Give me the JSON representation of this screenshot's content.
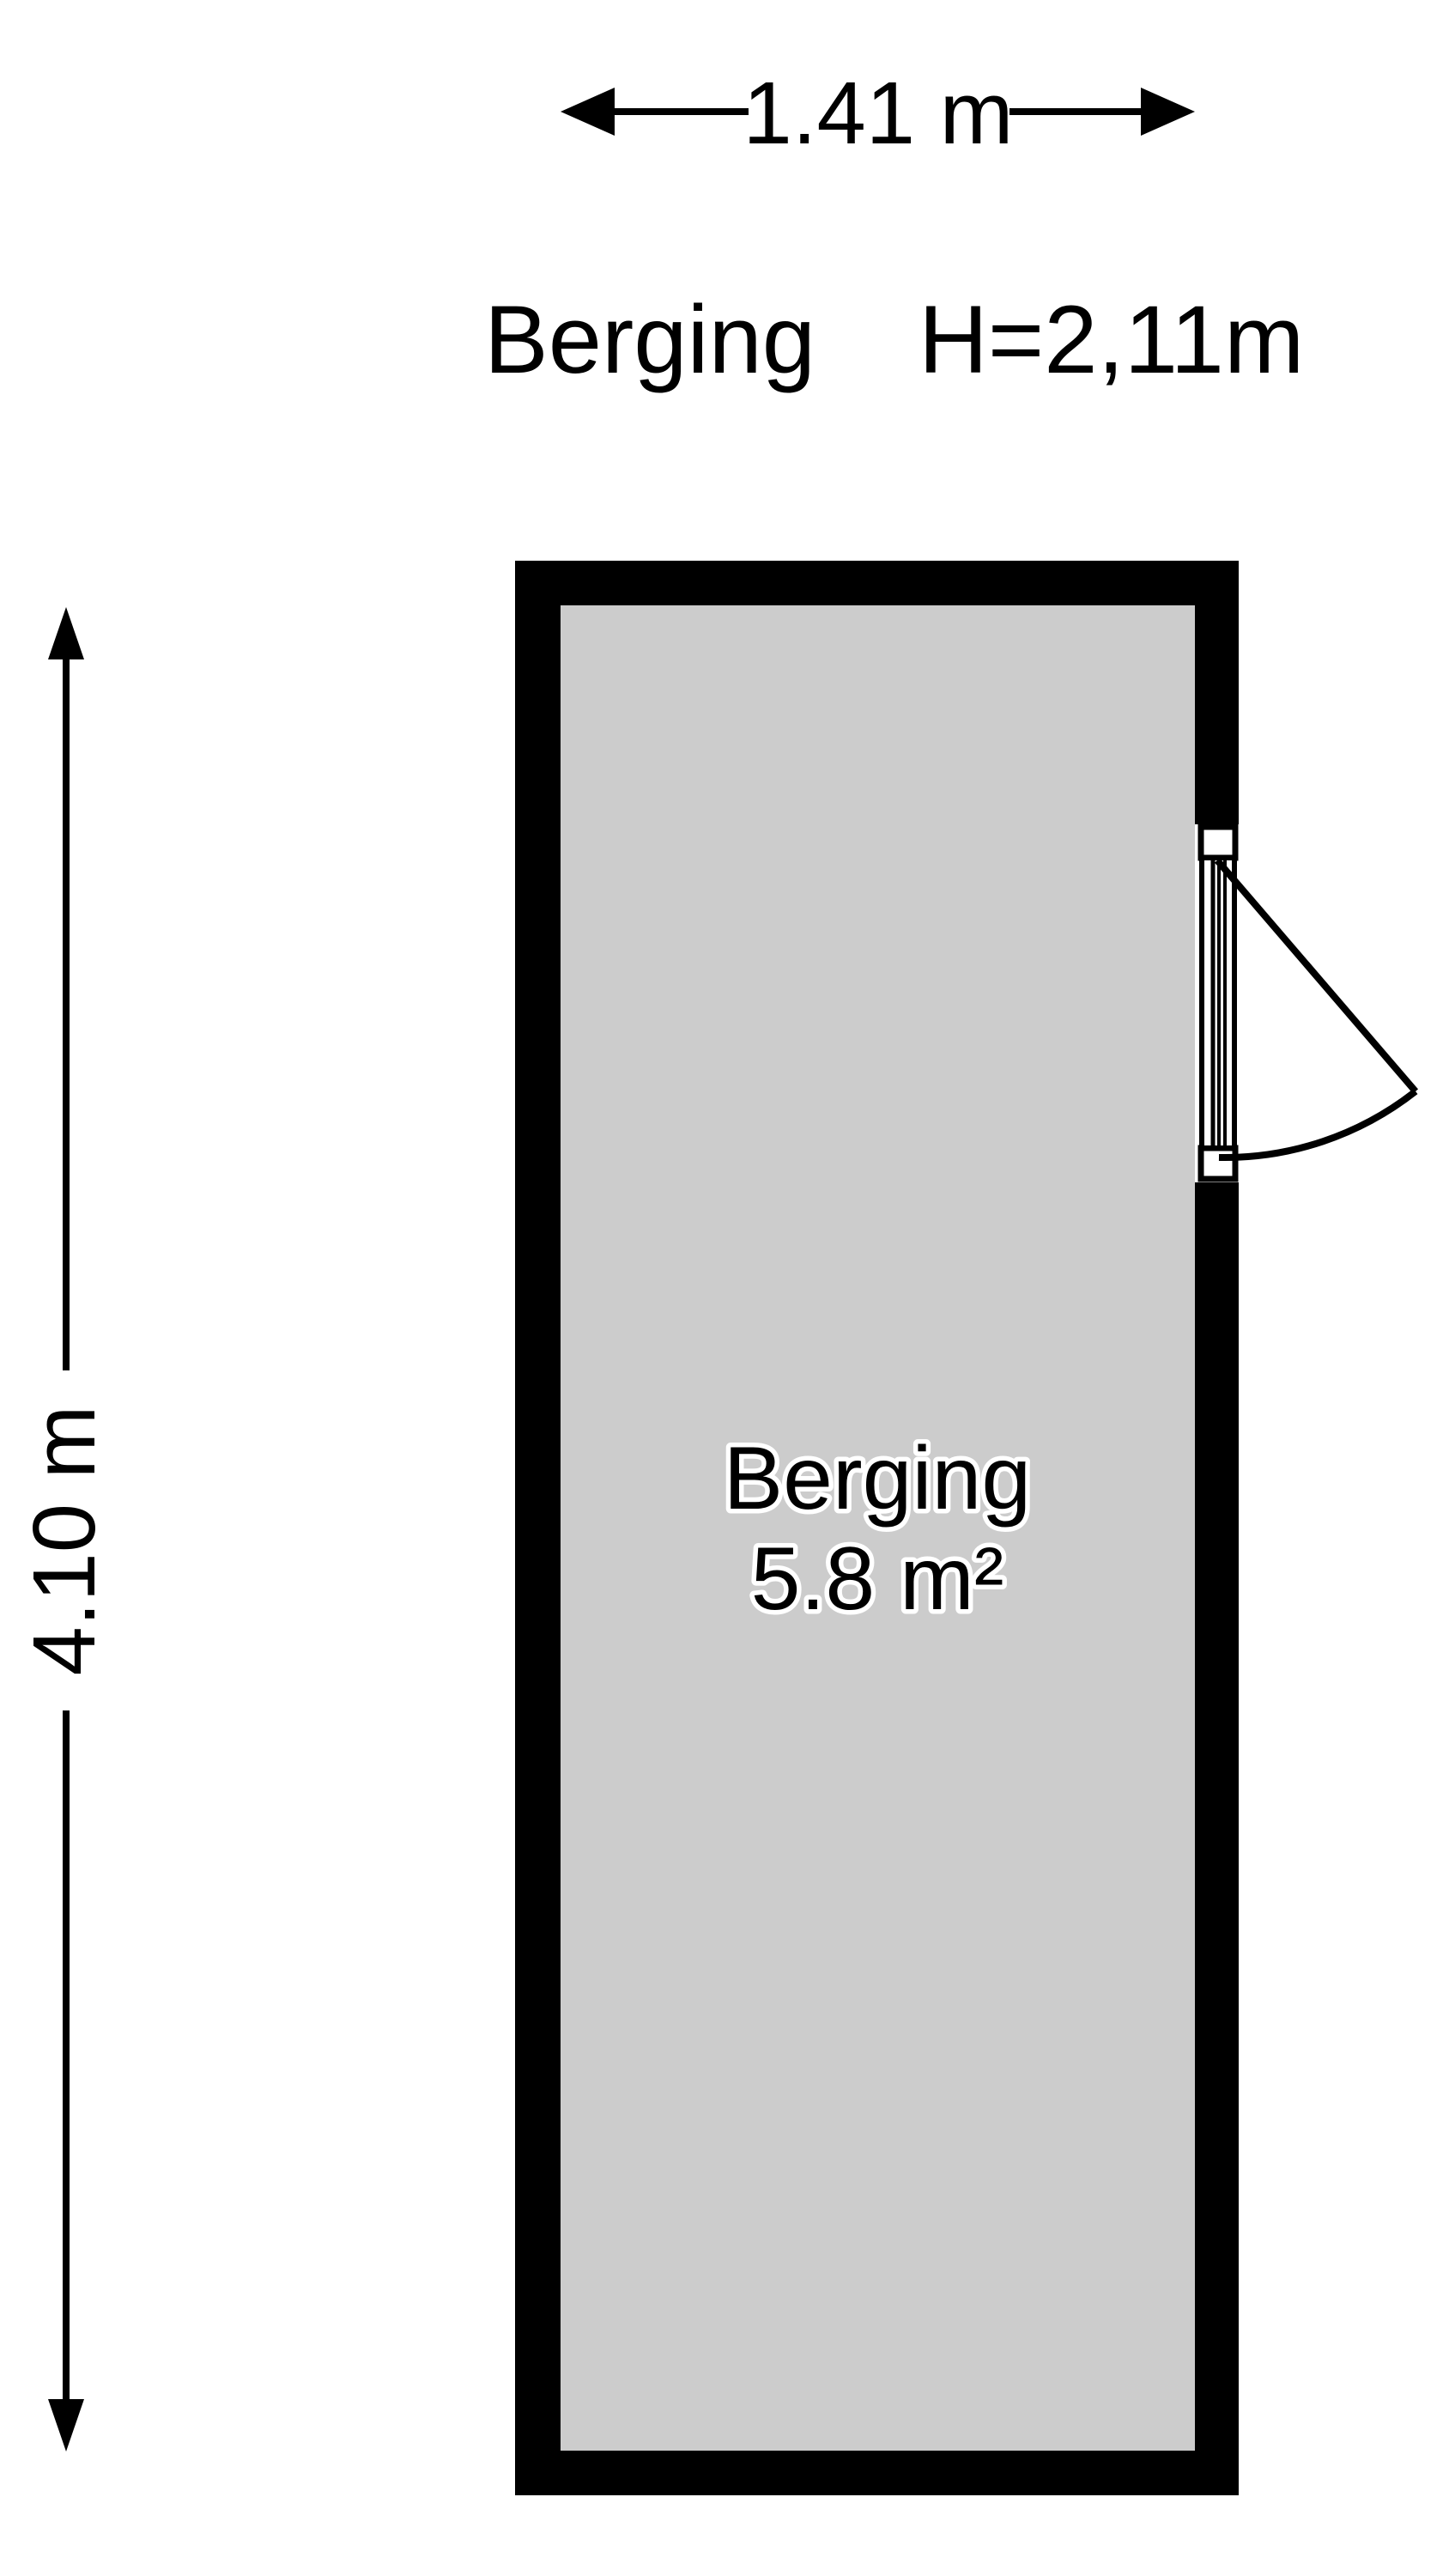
{
  "palette": {
    "background": "#ffffff",
    "wall_color": "#000000",
    "floor_color": "#cccccc",
    "line_color": "#000000",
    "label_halo_color": "#ffffff"
  },
  "top_dimension": {
    "label": "1.41 m"
  },
  "side_dimension": {
    "label": "4.10 m"
  },
  "header": {
    "room_name": "Berging",
    "ceiling_height": "H=2,11m"
  },
  "room": {
    "name": "Berging",
    "area": "5.8 m²"
  }
}
